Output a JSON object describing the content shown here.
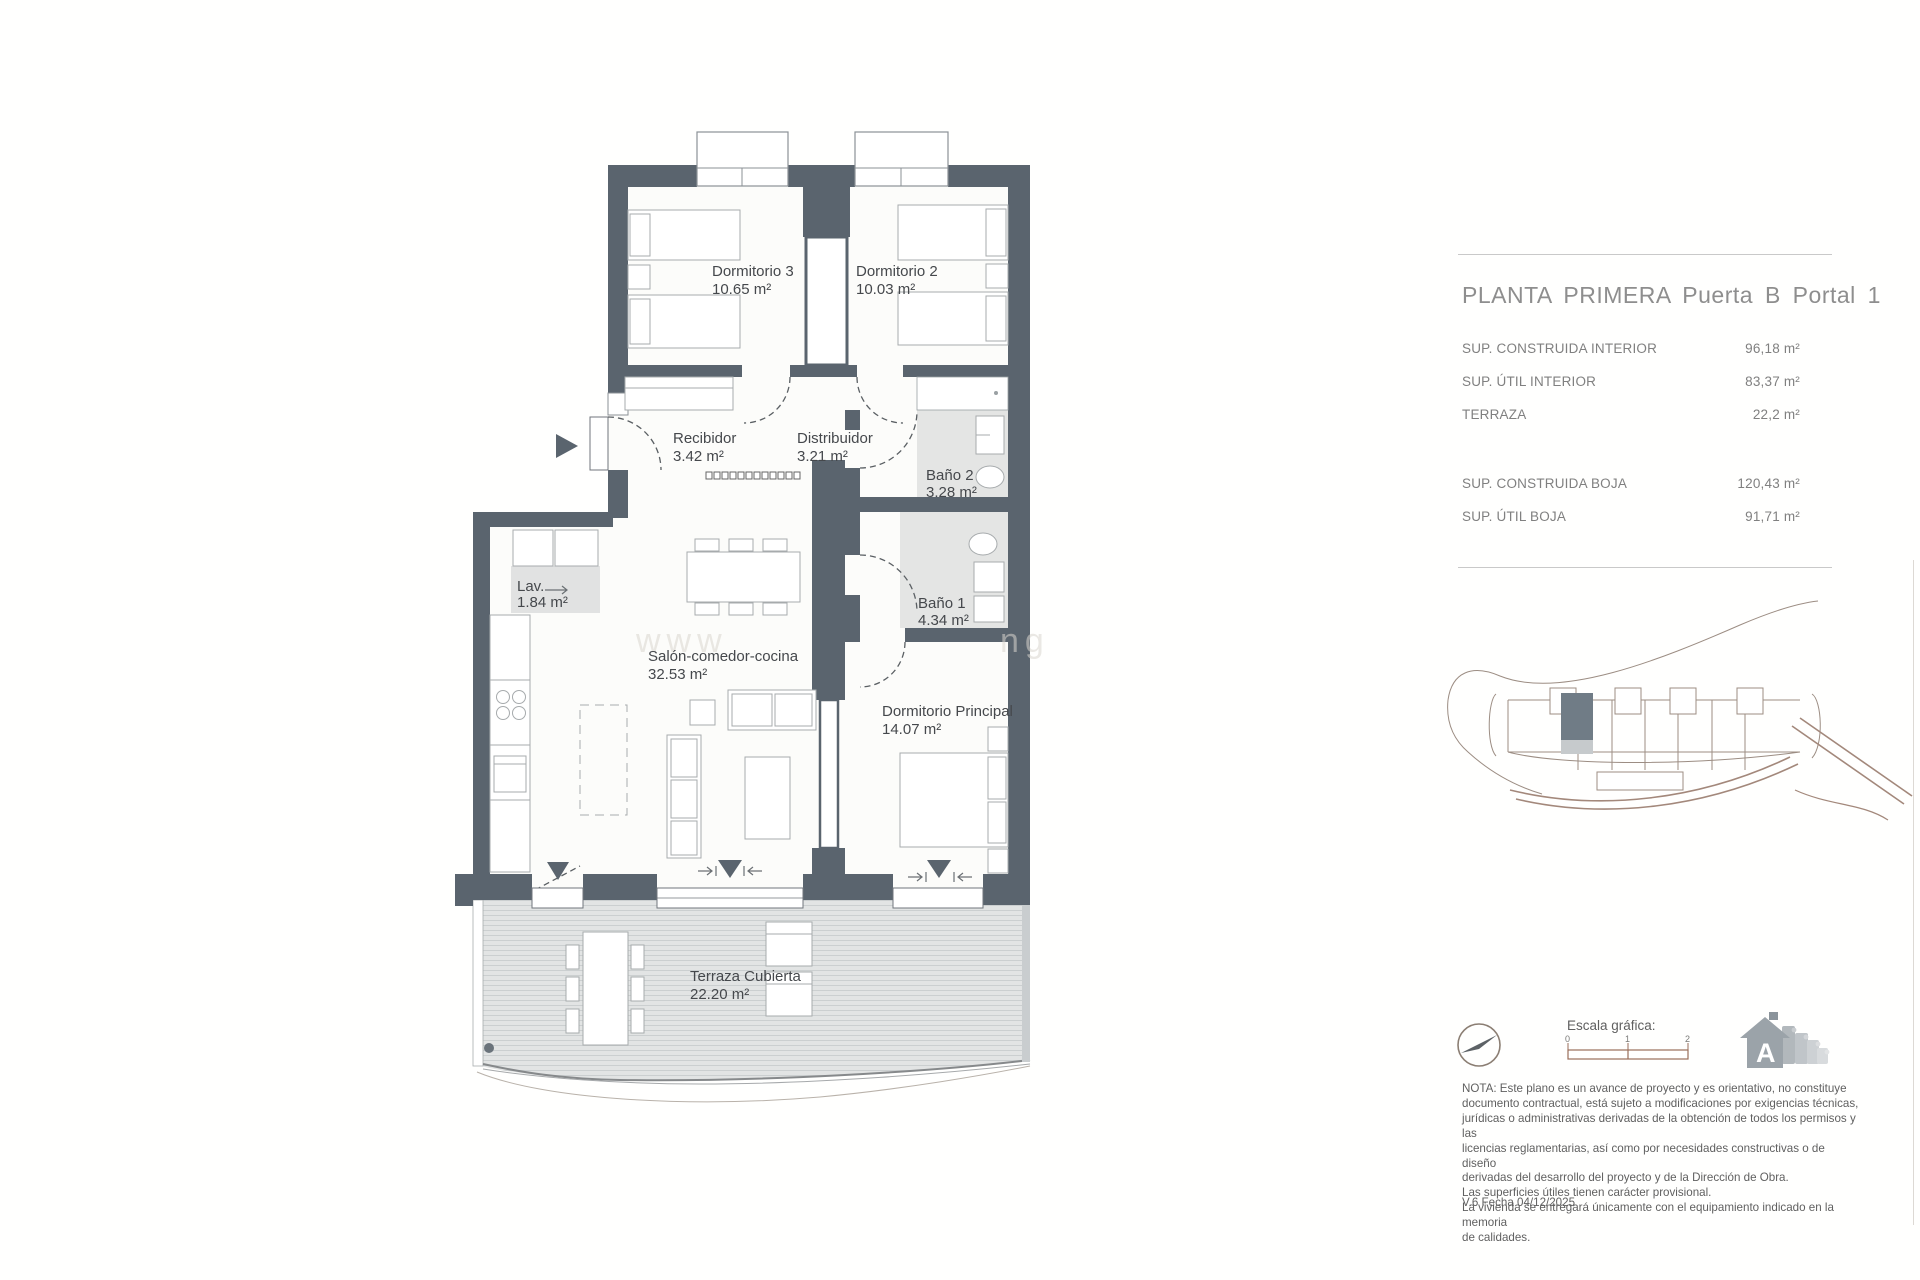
{
  "panel": {
    "title": "PLANTA PRIMERA Puerta B Portal 1",
    "rows": [
      {
        "label": "SUP. CONSTRUIDA INTERIOR",
        "value": "96,18 m²"
      },
      {
        "label": "SUP. ÚTIL INTERIOR",
        "value": "83,37 m²"
      },
      {
        "label": "TERRAZA",
        "value": "22,2 m²"
      },
      {
        "label": "SUP. CONSTRUIDA BOJA",
        "value": "120,43 m²"
      },
      {
        "label": "SUP. ÚTIL BOJA",
        "value": "91,71 m²"
      }
    ]
  },
  "plan": {
    "rooms": {
      "dorm3": {
        "name": "Dormitorio 3",
        "area": "10.65 m²"
      },
      "dorm2": {
        "name": "Dormitorio 2",
        "area": "10.03 m²"
      },
      "recibidor": {
        "name": "Recibidor",
        "area": "3.42 m²"
      },
      "distribuidor": {
        "name": "Distribuidor",
        "area": "3.21 m²"
      },
      "bano2": {
        "name": "Baño 2",
        "area": "3.28 m²"
      },
      "bano1": {
        "name": "Baño 1",
        "area": "4.34 m²"
      },
      "lav": {
        "name": "Lav.",
        "area": "1.84 m²"
      },
      "salon": {
        "name": "Salón-comedor-cocina",
        "area": "32.53 m²"
      },
      "principal": {
        "name": "Dormitorio Principal",
        "area": "14.07 m²"
      },
      "terraza": {
        "name": "Terraza Cubierta",
        "area": "22.20 m²"
      }
    },
    "watermark_left": "www",
    "watermark_right": "ng"
  },
  "footer": {
    "scale_label": "Escala gráfica:",
    "scale_ticks": [
      "0",
      "1",
      "2"
    ],
    "energy_letter": "A",
    "nota": "NOTA: Este plano es un avance de proyecto y es orientativo, no constituye\ndocumento contractual, está sujeto a modificaciones por exigencias técnicas,\njurídicas o administrativas derivadas de la obtención de todos los permisos y las\nlicencias reglamentarias, así como por necesidades constructivas o de diseño\nderivadas del desarrollo del proyecto y de la Dirección de Obra.\nLas superficies útiles tienen carácter provisional.\nLa vivienda se entregará únicamente con el equipamiento indicado en la memoria\nde calidades.",
    "version": "V.6 Fecha 04/12/2025"
  },
  "colors": {
    "wall": "#5a646e",
    "scale_bar": "#9a6e5a",
    "unit_highlight": "#707c86"
  }
}
